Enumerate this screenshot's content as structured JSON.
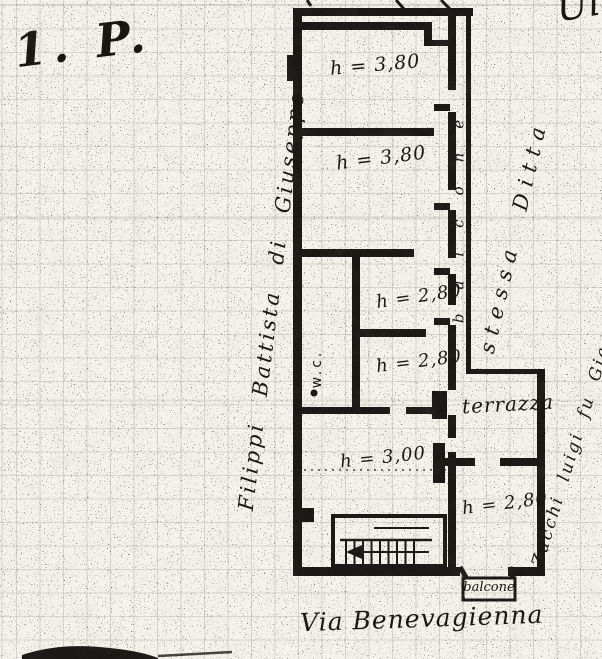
{
  "page": {
    "floor_label": "1. P.",
    "street_label": "Via Benevagienna",
    "top_right_fragment": "Ul"
  },
  "owners": {
    "left_side": "Filippi Battista di Giuseppe",
    "right_upper": "stessa Ditta",
    "right_lower": "Zucchi luigi fu Giacomo"
  },
  "plan": {
    "rooms": [
      {
        "id": "room-top",
        "height_label": "h = 3,80"
      },
      {
        "id": "room-second",
        "height_label": "h = 3,80"
      },
      {
        "id": "room-mid-upper",
        "height_label": "h = 2,80"
      },
      {
        "id": "room-mid-lower",
        "height_label": "h = 2,80"
      },
      {
        "id": "room-lower",
        "height_label": "h = 3,00"
      },
      {
        "id": "room-bottom-right",
        "height_label": "h = 2,80"
      }
    ],
    "labels": {
      "wc": "w.c.",
      "balcony_corridor": "balcone",
      "terrace": "terrazza",
      "balcony_bottom": "balcone"
    }
  },
  "colors": {
    "paper": "#f4f2ea",
    "ink": "#1b1a17",
    "grid_line": "#7a8476"
  }
}
